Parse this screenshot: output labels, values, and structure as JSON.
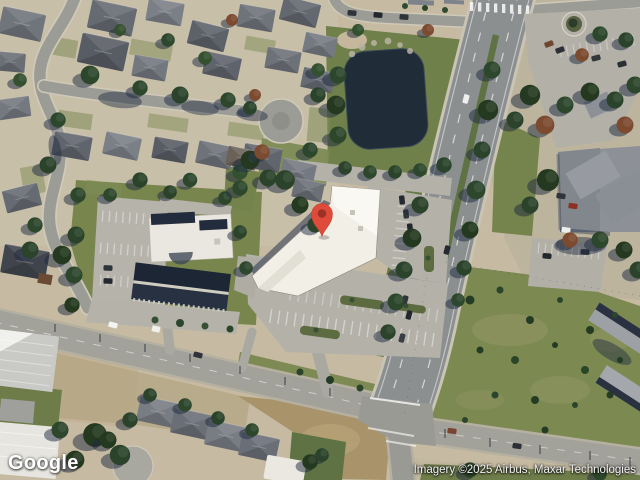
{
  "map": {
    "view_type": "satellite",
    "provider_logo": "Google",
    "attribution": "Imagery ©2025 Airbus, Maxar Technologies",
    "marker": {
      "color": "#DF4B3B",
      "dot_color": "#9E3026",
      "tip_x": 322,
      "tip_y": 236
    },
    "palette": {
      "ground": "#c6bba2",
      "grass": "#76854d",
      "water": "#202c38",
      "road": "#9c9c96",
      "highway": "#8b8f90",
      "white_roof": "#f2efe7",
      "navy_roof": "#1d2635"
    }
  }
}
